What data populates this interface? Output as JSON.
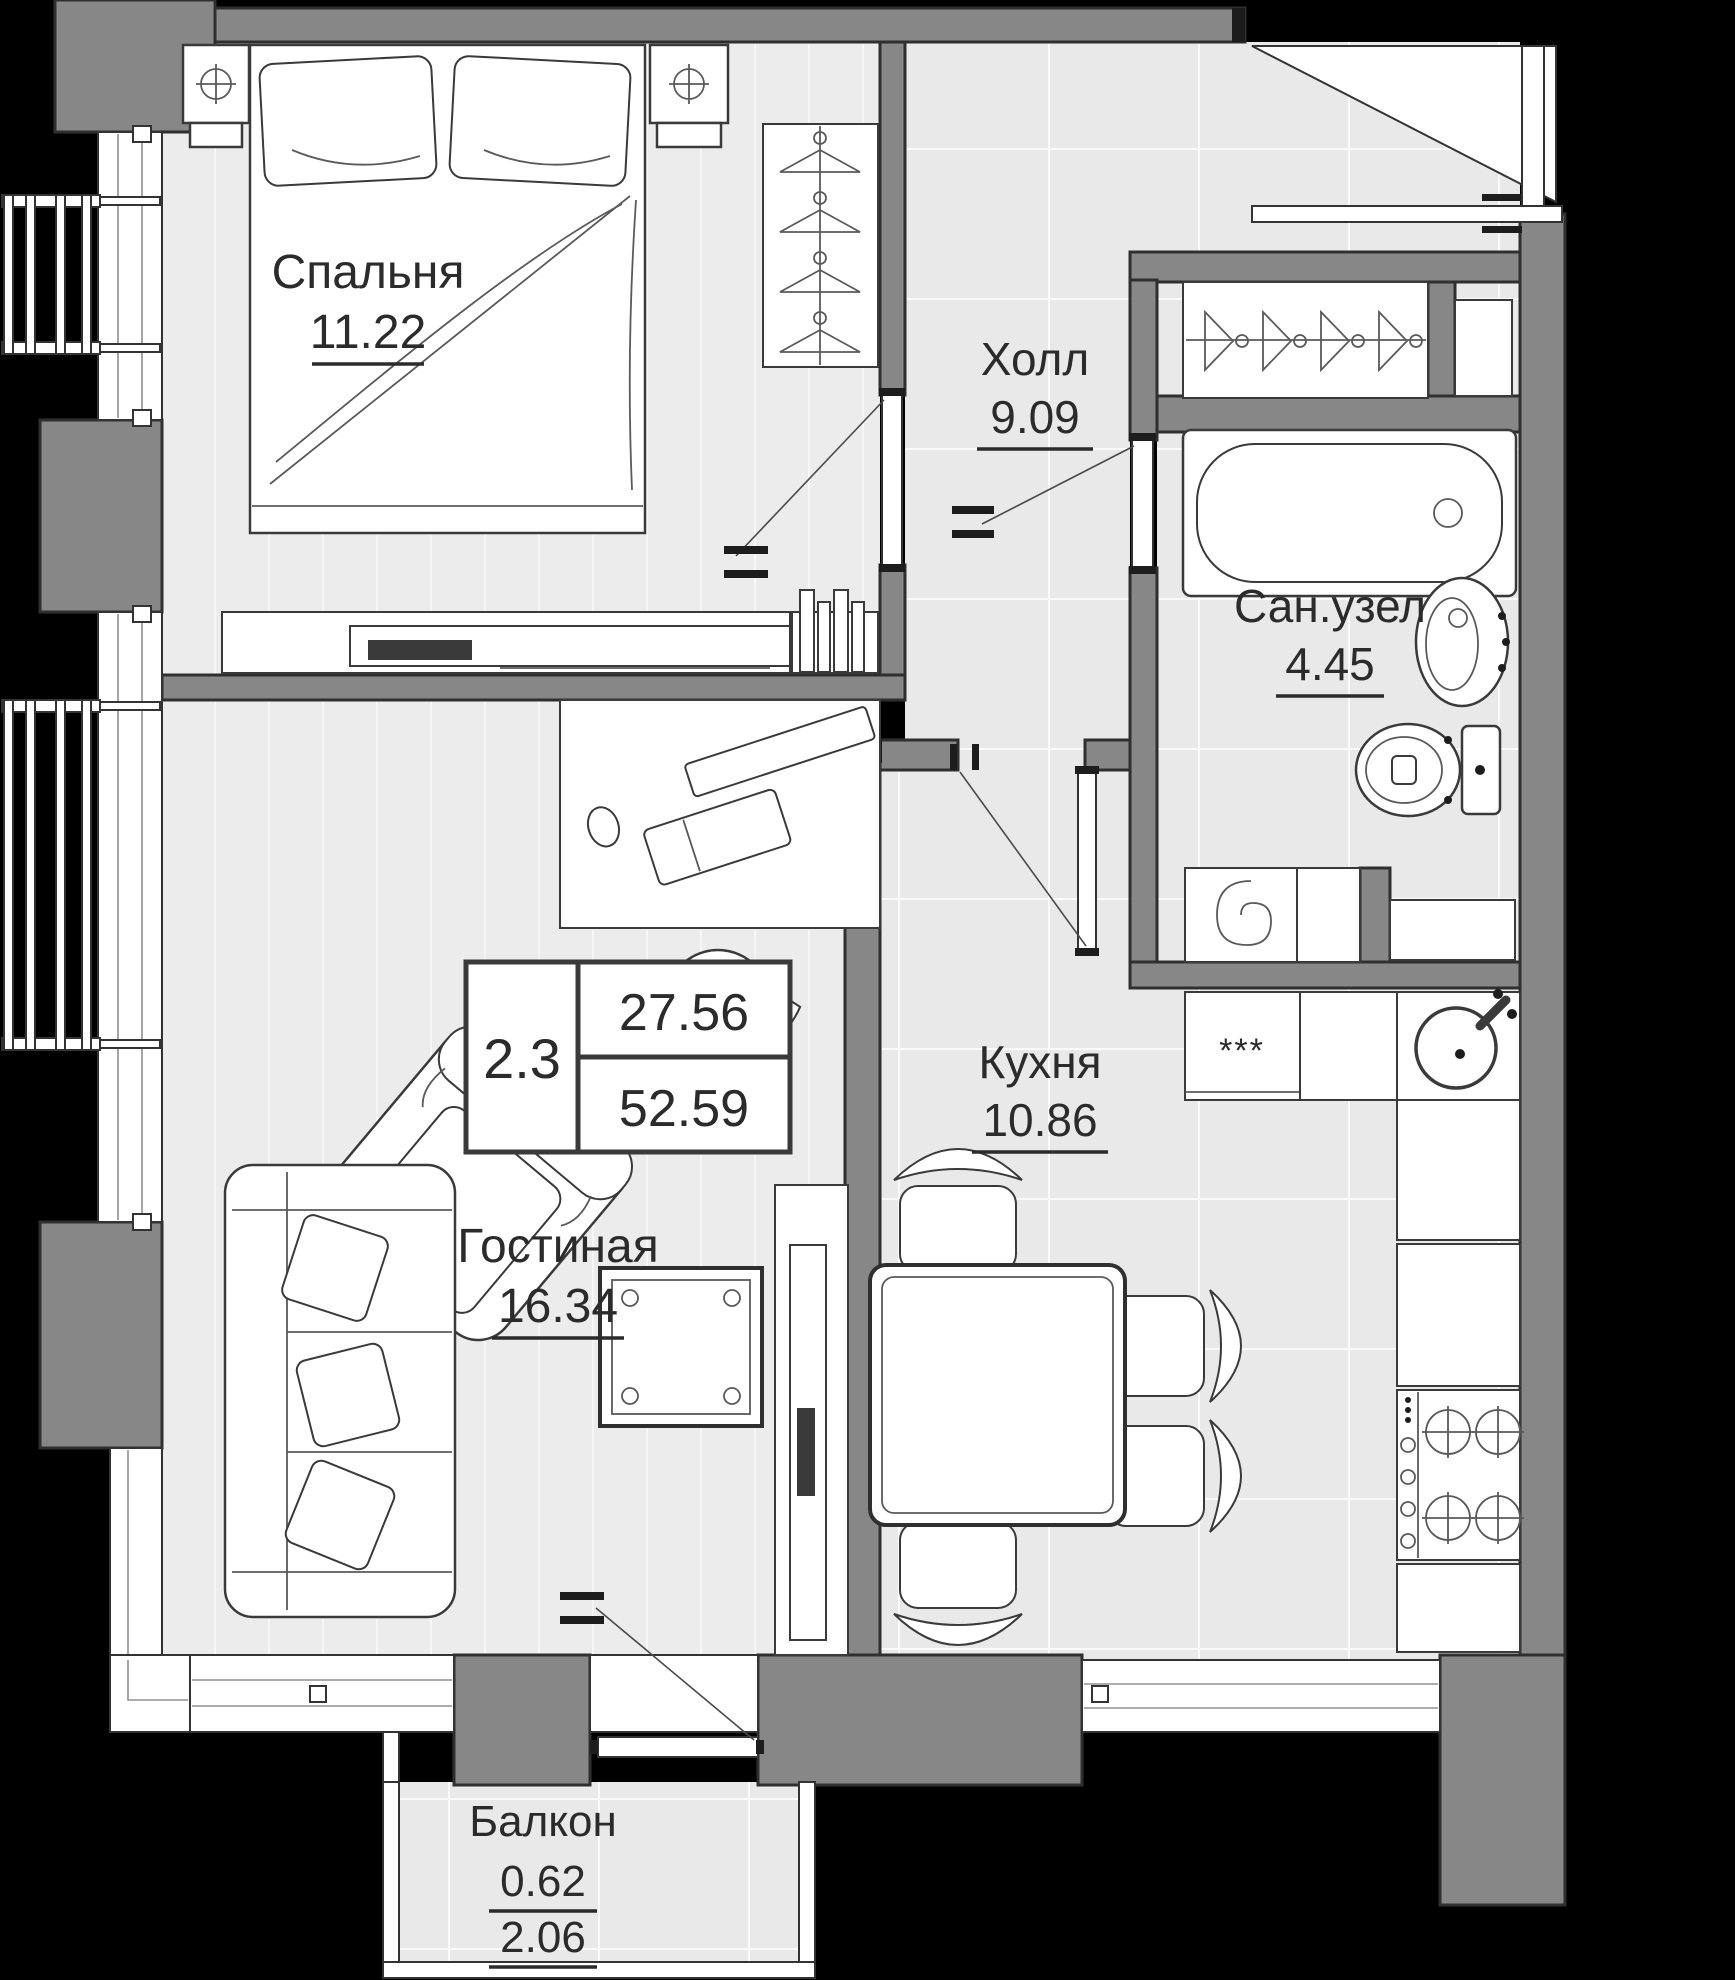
{
  "floor_plan": {
    "rooms": [
      {
        "id": "bedroom",
        "name": "Спальня",
        "area": "11.22"
      },
      {
        "id": "hall",
        "name": "Холл",
        "area": "9.09"
      },
      {
        "id": "bathroom",
        "name": "Сан.узел",
        "area": "4.45"
      },
      {
        "id": "kitchen",
        "name": "Кухня",
        "area": "10.86"
      },
      {
        "id": "living",
        "name": "Гостиная",
        "area": "16.34"
      },
      {
        "id": "balcony",
        "name": "Балкон",
        "area_reduced": "0.62",
        "area_full": "2.06"
      }
    ],
    "summary": {
      "plan_type": "2.3",
      "living_area": "27.56",
      "total_area": "52.59"
    },
    "fridge_mark": "***",
    "colors": {
      "background": "#000000",
      "wall": "#878787",
      "wall_outline": "#2f2f2f",
      "floor_wood": "#ececec",
      "floor_tile": "#e9e9e9",
      "furniture_outline": "#3a3a3a",
      "text": "#2b2b2b"
    }
  }
}
